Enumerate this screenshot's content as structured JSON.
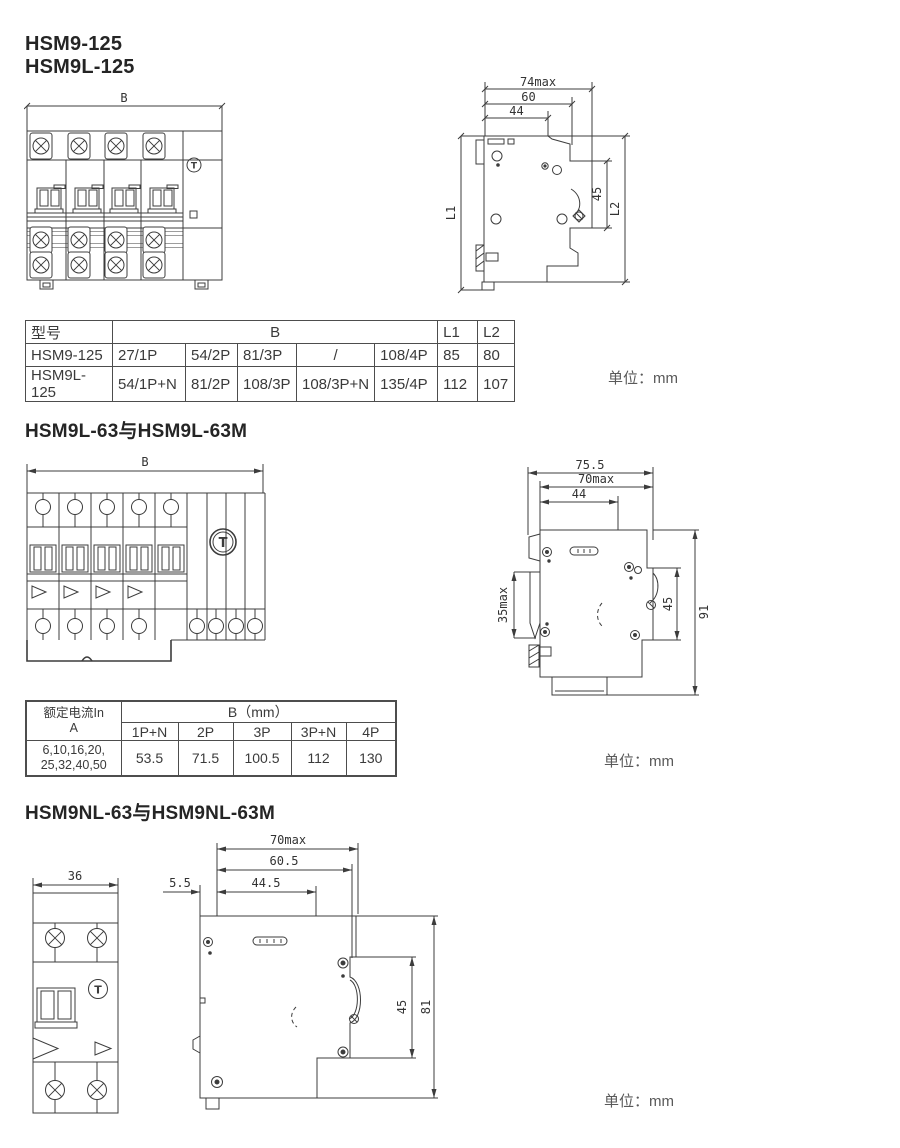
{
  "page": {
    "unit_label": "单位：mm",
    "t_symbol": "T"
  },
  "section1": {
    "title_line1": "HSM9-125",
    "title_line2": "HSM9L-125",
    "front": {
      "b": "B"
    },
    "side": {
      "w1": "74max",
      "w2": "60",
      "w3": "44",
      "h45": "45",
      "l1": "L1",
      "l2": "L2"
    },
    "table": {
      "h_model": "型号",
      "h_b": "B",
      "h_l1": "L1",
      "h_l2": "L2",
      "rows": [
        {
          "model": "HSM9-125",
          "b0": "27/1P",
          "b1": "54/2P",
          "b2": "81/3P",
          "b3": "/",
          "b4": "108/4P",
          "l1": "85",
          "l2": "80"
        },
        {
          "model": "HSM9L-125",
          "b0": "54/1P+N",
          "b1": "81/2P",
          "b2": "108/3P",
          "b3": "108/3P+N",
          "b4": "135/4P",
          "l1": "112",
          "l2": "107"
        }
      ]
    }
  },
  "section2": {
    "title": "HSM9L-63与HSM9L-63M",
    "front": {
      "b": "B"
    },
    "side": {
      "w1": "75.5",
      "w2": "70max",
      "w3": "44",
      "hleft": "35max",
      "h45": "45",
      "h91": "91"
    },
    "table": {
      "h_current1": "额定电流In",
      "h_current2": "A",
      "h_b": "B（mm）",
      "cols": [
        "1P+N",
        "2P",
        "3P",
        "3P+N",
        "4P"
      ],
      "current1": "6,10,16,20,",
      "current2": "25,32,40,50",
      "values": [
        "53.5",
        "71.5",
        "100.5",
        "112",
        "130"
      ]
    }
  },
  "section3": {
    "title": "HSM9NL-63与HSM9NL-63M",
    "front": {
      "w": "36"
    },
    "side": {
      "w1": "70max",
      "w2": "60.5",
      "w3": "44.5",
      "w4": "5.5",
      "h45": "45",
      "h81": "81"
    }
  }
}
